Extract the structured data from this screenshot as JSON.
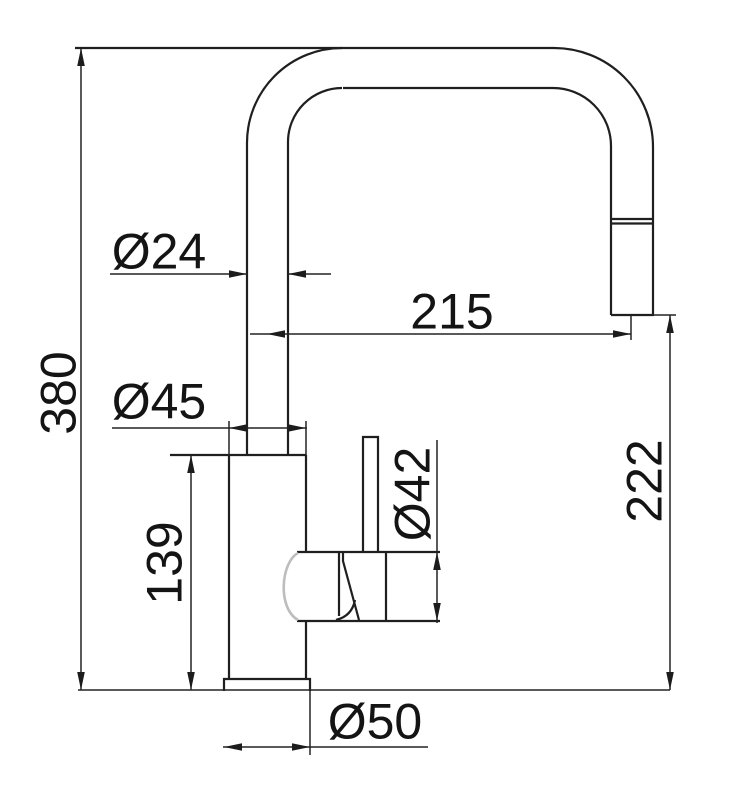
{
  "drawing": {
    "kind": "technical-dimension-drawing",
    "subject": "single-lever kitchen mixer tap with high U-shaped swivel spout, side view",
    "dimensions": {
      "spout_tube_diameter": {
        "label": "Ø24",
        "value": 24,
        "measures": "spout tube diameter"
      },
      "spout_reach": {
        "label": "215",
        "value": 215,
        "measures": "horizontal reach, riser centre to outlet centre"
      },
      "overall_height": {
        "label": "380",
        "value": 380,
        "measures": "overall height from base to top of spout"
      },
      "body_diameter": {
        "label": "Ø45",
        "value": 45,
        "measures": "body column diameter"
      },
      "cartridge_diameter": {
        "label": "Ø42",
        "value": 42,
        "measures": "lever housing diameter"
      },
      "body_height": {
        "label": "139",
        "value": 139,
        "measures": "body column height"
      },
      "outlet_height": {
        "label": "222",
        "value": 222,
        "measures": "height of outlet above base"
      },
      "base_diameter": {
        "label": "Ø50",
        "value": 50,
        "measures": "base flange diameter"
      }
    }
  },
  "colors": {
    "background": "#ffffff",
    "object_line": "#1f1f1f",
    "dimension_line": "#242424",
    "text": "#141414",
    "housing_cap_gray": "#bdbdbd"
  }
}
